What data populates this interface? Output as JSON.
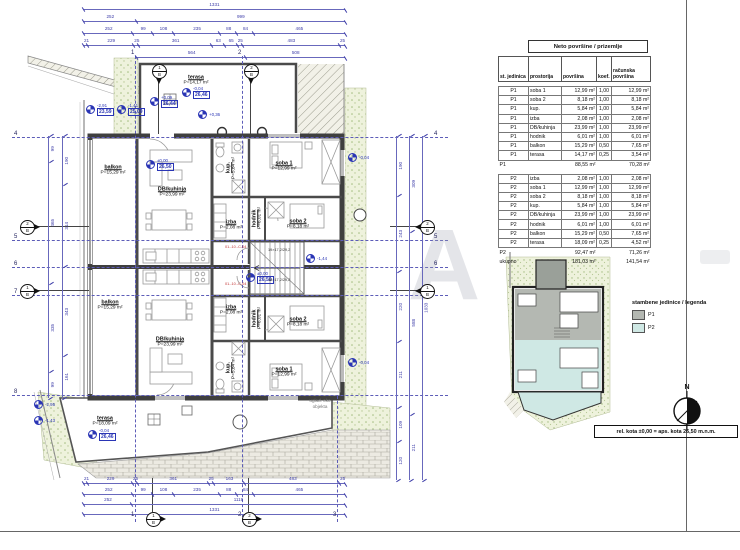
{
  "drawing": {
    "note": "rel. kota ±0,00 = aps. kota 26,50 m.n.m.",
    "north_label": "N",
    "watermark": "A",
    "site_label": "uglađ. oko objekta"
  },
  "table": {
    "title": "Neto površine / prizemlje",
    "columns": [
      "st. jedinica",
      "prostorija",
      "površina",
      "koef.",
      "računska površina"
    ],
    "p1": {
      "rows": [
        [
          "P1",
          "soba 1",
          "12,99 m²",
          "1,00",
          "12,99 m²"
        ],
        [
          "P1",
          "soba 2",
          "8,18 m²",
          "1,00",
          "8,18 m²"
        ],
        [
          "P1",
          "kup.",
          "5,84 m²",
          "1,00",
          "5,84 m²"
        ],
        [
          "P1",
          "izba",
          "2,08 m²",
          "1,00",
          "2,08 m²"
        ],
        [
          "P1",
          "DB/kuhinja",
          "23,99 m²",
          "1,00",
          "23,99 m²"
        ],
        [
          "P1",
          "hodnik",
          "6,01 m²",
          "1,00",
          "6,01 m²"
        ],
        [
          "P1",
          "balkon",
          "15,29 m²",
          "0,50",
          "7,65 m²"
        ],
        [
          "P1",
          "terasa",
          "14,17 m²",
          "0,25",
          "3,54 m²"
        ]
      ],
      "total": {
        "label": "P1",
        "area": "88,55 m²",
        "calc": "70,28 m²"
      }
    },
    "p2": {
      "rows": [
        [
          "P2",
          "izba",
          "2,08 m²",
          "1,00",
          "2,08 m²"
        ],
        [
          "P2",
          "soba 1",
          "12,99 m²",
          "1,00",
          "12,99 m²"
        ],
        [
          "P2",
          "soba 2",
          "8,18 m²",
          "1,00",
          "8,18 m²"
        ],
        [
          "P2",
          "kup.",
          "5,84 m²",
          "1,00",
          "5,84 m²"
        ],
        [
          "P2",
          "DB/kuhinja",
          "23,99 m²",
          "1,00",
          "23,99 m²"
        ],
        [
          "P2",
          "hodnik",
          "6,01 m²",
          "1,00",
          "6,01 m²"
        ],
        [
          "P2",
          "balkon",
          "15,29 m²",
          "0,50",
          "7,65 m²"
        ],
        [
          "P2",
          "terasa",
          "18,09 m²",
          "0,25",
          "4,52 m²"
        ]
      ],
      "total": {
        "label": "P2",
        "area": "92,47 m²",
        "calc": "71,26 m²"
      }
    },
    "grand": {
      "label": "ukupno",
      "area": "181,03 m²",
      "calc": "141,54 m²"
    }
  },
  "legend": {
    "title": "stambene jedinice / legenda",
    "items": [
      {
        "label": "P1"
      },
      {
        "label": "P2"
      }
    ],
    "colors": {
      "p1": "#b4b8b2",
      "p2": "#cfe8e4"
    }
  },
  "plan": {
    "rooms": {
      "p1_terasa": {
        "name": "terasa",
        "area": "P=14,17 m²"
      },
      "p1_balkon": {
        "name": "balkon",
        "area": "P=15,29 m²"
      },
      "p1_db": {
        "name": "DB/kuhinja",
        "area": "P=23,99 m²"
      },
      "p1_kup": {
        "name": "kup.",
        "area": "P=5,84 m²"
      },
      "p1_izba": {
        "name": "izba",
        "area": "P=2,08 m²"
      },
      "p1_hodnik": {
        "name": "hodnik",
        "area": "P=6,01 m²"
      },
      "p1_soba1": {
        "name": "soba 1",
        "area": "P=12,99 m²"
      },
      "p1_soba2": {
        "name": "soba 2",
        "area": "P=8,18 m²"
      },
      "p2_terasa": {
        "name": "terasa",
        "area": "P=18,09 m²"
      },
      "p2_balkon": {
        "name": "balkon",
        "area": "P=15,29 m²"
      },
      "p2_db": {
        "name": "DB/kuhinja",
        "area": "P=23,99 m²"
      },
      "p2_kup": {
        "name": "kup.",
        "area": "P=5,84 m²"
      },
      "p2_izba": {
        "name": "izba",
        "area": "P=2,08 m²"
      },
      "p2_hodnik": {
        "name": "hodnik",
        "area": "P=6,01 m²"
      },
      "p2_soba1": {
        "name": "soba 1",
        "area": "P=12,99 m²"
      },
      "p2_soba2": {
        "name": "soba 2",
        "area": "P=8,18 m²"
      }
    },
    "elevations": {
      "e1": {
        "rel": "-2,91",
        "abs": "23,59"
      },
      "e2": {
        "rel": "-1,41",
        "abs": "25,09"
      },
      "e3": {
        "rel": "+0,09",
        "abs": "26,44"
      },
      "e4": {
        "rel": "-0,04",
        "abs": "26,46"
      },
      "e5": {
        "rel": "±0,00",
        "abs": "26,50"
      },
      "e6": {
        "rel": "±0,00",
        "abs": "26,50"
      },
      "e7a": {
        "rel": "-0,04"
      },
      "e7b": {
        "rel": "-0,04"
      },
      "e8": {
        "rel": "-0,04",
        "abs": "26,46"
      },
      "e9": {
        "rel": "-2,95"
      },
      "e10": {
        "rel": "-1,43"
      },
      "e11": {
        "rel": "-1,44"
      },
      "e12": {
        "rel": "+0,36"
      }
    },
    "stairs": {
      "code_top": "01.-10.-C-04",
      "code_bottom": "01.-10.-C-04",
      "text_top": "19×17,2/29,2",
      "text_bottom": "18×17,2/29,2"
    },
    "axes": {
      "top": [
        "1",
        "2"
      ],
      "bottom": [
        "1",
        "2",
        "3"
      ],
      "left": [
        "4",
        "5",
        "6",
        "7",
        "8"
      ],
      "right": [
        "4",
        "5",
        "6"
      ]
    },
    "sections": {
      "left_top": {
        "num": "2",
        "ref": "B"
      },
      "left_bottom": {
        "num": "1",
        "ref": "B"
      },
      "right_top": {
        "num": "2",
        "ref": "B"
      },
      "right_bottom": {
        "num": "1",
        "ref": "B"
      },
      "top_1": {
        "num": "1",
        "ref": "B"
      },
      "top_2": {
        "num": "2",
        "ref": "B"
      },
      "bottom_1": {
        "num": "1",
        "ref": "B"
      },
      "bottom_2": {
        "num": "2",
        "ref": "B"
      }
    },
    "dims": {
      "top": [
        [
          "1331"
        ],
        [
          "252",
          "999"
        ],
        [
          "252",
          "99",
          "108",
          "235",
          "88",
          "84",
          "465"
        ],
        [
          "21",
          "229",
          "25",
          "361",
          "63",
          "65",
          "25",
          "483",
          "25"
        ],
        [
          "564",
          "508"
        ]
      ],
      "bottom": [
        [
          "21",
          "229",
          "25",
          "361",
          "25",
          "163",
          "483",
          "25"
        ],
        [
          "252",
          "99",
          "108",
          "235",
          "88",
          "84",
          "465"
        ],
        [
          "252",
          "1119"
        ],
        [
          "1331"
        ]
      ],
      "left": [
        [
          "99",
          "465",
          "335",
          "99"
        ],
        [
          "190",
          "314",
          "343",
          "161"
        ]
      ],
      "right": [
        [
          "190",
          "243",
          "220",
          "211",
          "109",
          "120"
        ],
        [
          "309",
          "588",
          "211"
        ],
        [
          "1033"
        ]
      ]
    }
  }
}
